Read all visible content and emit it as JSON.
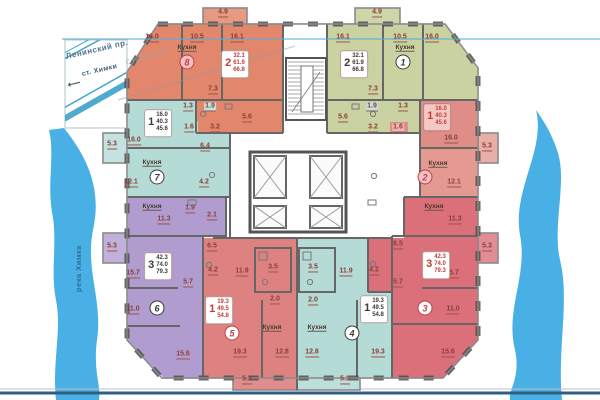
{
  "map": {
    "street1": "Ленинский пр.",
    "street2": "ст. Химки",
    "arrow": "⟵",
    "district": "Старбеево",
    "river": "река Химка"
  },
  "plan": {
    "kitchen_text": "Кухня",
    "kitchen_labels": [
      {
        "x": 187,
        "y": 48
      },
      {
        "x": 405,
        "y": 48
      },
      {
        "x": 152,
        "y": 163
      },
      {
        "x": 438,
        "y": 164
      },
      {
        "x": 152,
        "y": 207
      },
      {
        "x": 434,
        "y": 207
      },
      {
        "x": 272,
        "y": 328
      },
      {
        "x": 317,
        "y": 328
      }
    ],
    "units": [
      {
        "n": "8",
        "rooms": "2",
        "areas": [
          "32.1",
          "61.9",
          "66.8"
        ],
        "badge": {
          "x": 187,
          "y": 62,
          "bg": "#F6BFC6",
          "fg": "#C03F3C"
        },
        "card": {
          "x": 235,
          "y": 64,
          "accent": "#C03F3C",
          "bg": "#ffffff"
        }
      },
      {
        "n": "1",
        "rooms": "2",
        "areas": [
          "32.1",
          "61.9",
          "66.8"
        ],
        "badge": {
          "x": 403,
          "y": 62,
          "bg": "#ffffff",
          "fg": "#3B3B3B"
        },
        "card": {
          "x": 354,
          "y": 64,
          "accent": "#3B3B3B",
          "bg": "#ffffff"
        }
      },
      {
        "n": "7",
        "rooms": "1",
        "areas": [
          "16.0",
          "40.3",
          "45.6"
        ],
        "badge": {
          "x": 157,
          "y": 177,
          "bg": "#ffffff",
          "fg": "#3B3B3B"
        },
        "card": {
          "x": 158,
          "y": 123,
          "accent": "#3B3B3B",
          "bg": "#ffffff"
        }
      },
      {
        "n": "2",
        "rooms": "1",
        "areas": [
          "16.0",
          "40.3",
          "45.6"
        ],
        "badge": {
          "x": 425,
          "y": 177,
          "bg": "#F6BFC6",
          "fg": "#C03F3C"
        },
        "card": {
          "x": 437,
          "y": 117,
          "accent": "#C03F3C",
          "bg": "#F6C8C4"
        }
      },
      {
        "n": "6",
        "rooms": "3",
        "areas": [
          "42.3",
          "74.0",
          "79.3"
        ],
        "badge": {
          "x": 157,
          "y": 308,
          "bg": "#ffffff",
          "fg": "#3B3B3B"
        },
        "card": {
          "x": 158,
          "y": 266,
          "accent": "#3B3B3B",
          "bg": "#ffffff"
        }
      },
      {
        "n": "3",
        "rooms": "3",
        "areas": [
          "42.3",
          "74.0",
          "79.3"
        ],
        "badge": {
          "x": 425,
          "y": 308,
          "bg": "#ffffff",
          "fg": "#C03F3C"
        },
        "card": {
          "x": 436,
          "y": 265,
          "accent": "#C03F3C",
          "bg": "#ffffff"
        }
      },
      {
        "n": "5",
        "rooms": "1",
        "areas": [
          "19.3",
          "49.5",
          "54.8"
        ],
        "badge": {
          "x": 232,
          "y": 333,
          "bg": "#ffffff",
          "fg": "#C03F3C"
        },
        "card": {
          "x": 219,
          "y": 310,
          "accent": "#C03F3C",
          "bg": "#ffffff"
        }
      },
      {
        "n": "4",
        "rooms": "1",
        "areas": [
          "19.3",
          "49.5",
          "54.8"
        ],
        "badge": {
          "x": 352,
          "y": 333,
          "bg": "#ffffff",
          "fg": "#3B3B3B"
        },
        "card": {
          "x": 374,
          "y": 309,
          "accent": "#3B3B3B",
          "bg": "#ffffff"
        }
      }
    ],
    "dim_labels": [
      {
        "t": "16.0",
        "x": 152,
        "y": 38
      },
      {
        "t": "10.5",
        "x": 197,
        "y": 38
      },
      {
        "t": "16.1",
        "x": 237,
        "y": 38
      },
      {
        "t": "4.9",
        "x": 223,
        "y": 13
      },
      {
        "t": "4.9",
        "x": 377,
        "y": 13
      },
      {
        "t": "16.1",
        "x": 343,
        "y": 38
      },
      {
        "t": "10.5",
        "x": 400,
        "y": 38
      },
      {
        "t": "16.0",
        "x": 432,
        "y": 38
      },
      {
        "t": "7.3",
        "x": 213,
        "y": 90
      },
      {
        "t": "1.3",
        "x": 188,
        "y": 107
      },
      {
        "t": "1.9",
        "x": 210,
        "y": 107,
        "bg": "#BFE3DF"
      },
      {
        "t": "5.6",
        "x": 247,
        "y": 118
      },
      {
        "t": "1.6",
        "x": 189,
        "y": 128
      },
      {
        "t": "3.2",
        "x": 215,
        "y": 128
      },
      {
        "t": "7.3",
        "x": 373,
        "y": 90
      },
      {
        "t": "1.9",
        "x": 372,
        "y": 107,
        "bg": "#BFE3DF"
      },
      {
        "t": "1.3",
        "x": 403,
        "y": 107
      },
      {
        "t": "5.6",
        "x": 343,
        "y": 118
      },
      {
        "t": "3.2",
        "x": 373,
        "y": 128
      },
      {
        "t": "1.6",
        "x": 398,
        "y": 128,
        "bg": "#F0B6B2"
      },
      {
        "t": "16.0",
        "x": 134,
        "y": 141
      },
      {
        "t": "5.3",
        "x": 112,
        "y": 145
      },
      {
        "t": "6.4",
        "x": 205,
        "y": 147
      },
      {
        "t": "12.1",
        "x": 131,
        "y": 183
      },
      {
        "t": "4.2",
        "x": 204,
        "y": 183
      },
      {
        "t": "16.0",
        "x": 451,
        "y": 139
      },
      {
        "t": "5.3",
        "x": 487,
        "y": 147
      },
      {
        "t": "12.1",
        "x": 454,
        "y": 183
      },
      {
        "t": "11.3",
        "x": 164,
        "y": 220
      },
      {
        "t": "1.9",
        "x": 190,
        "y": 209
      },
      {
        "t": "2.1",
        "x": 212,
        "y": 216
      },
      {
        "t": "11.3",
        "x": 455,
        "y": 220
      },
      {
        "t": "5.3",
        "x": 112,
        "y": 247
      },
      {
        "t": "6.5",
        "x": 212,
        "y": 247
      },
      {
        "t": "15.7",
        "x": 133,
        "y": 274
      },
      {
        "t": "5.7",
        "x": 188,
        "y": 283
      },
      {
        "t": "4.2",
        "x": 213,
        "y": 271
      },
      {
        "t": "11.0",
        "x": 133,
        "y": 310
      },
      {
        "t": "15.6",
        "x": 183,
        "y": 355
      },
      {
        "t": "6.5",
        "x": 398,
        "y": 245
      },
      {
        "t": "5.3",
        "x": 487,
        "y": 247
      },
      {
        "t": "15.7",
        "x": 452,
        "y": 274
      },
      {
        "t": "5.7",
        "x": 398,
        "y": 283
      },
      {
        "t": "4.2",
        "x": 374,
        "y": 271
      },
      {
        "t": "11.0",
        "x": 453,
        "y": 310
      },
      {
        "t": "15.6",
        "x": 448,
        "y": 353
      },
      {
        "t": "11.9",
        "x": 242,
        "y": 272
      },
      {
        "t": "3.5",
        "x": 273,
        "y": 268
      },
      {
        "t": "2.0",
        "x": 275,
        "y": 300
      },
      {
        "t": "19.3",
        "x": 240,
        "y": 353
      },
      {
        "t": "12.8",
        "x": 282,
        "y": 353
      },
      {
        "t": "5.3",
        "x": 247,
        "y": 380
      },
      {
        "t": "11.9",
        "x": 346,
        "y": 272
      },
      {
        "t": "3.5",
        "x": 313,
        "y": 268
      },
      {
        "t": "2.0",
        "x": 313,
        "y": 301
      },
      {
        "t": "12.8",
        "x": 312,
        "y": 353
      },
      {
        "t": "19.3",
        "x": 378,
        "y": 353
      },
      {
        "t": "5.3",
        "x": 345,
        "y": 380
      }
    ],
    "colors": {
      "orange": "#E3876C",
      "green": "#C9D2A0",
      "teal": "#B5DBD7",
      "purple": "#B19CD0",
      "red5": "#DE8181",
      "red1": "#DE8D87",
      "pink2": "#E49A90",
      "rose3": "#DB6F7A",
      "river": "#48B0E4",
      "wall": "#666666",
      "dim_text": "#8A4036",
      "navy_line": "#2E5E86",
      "road": "#3BA3C8"
    }
  }
}
